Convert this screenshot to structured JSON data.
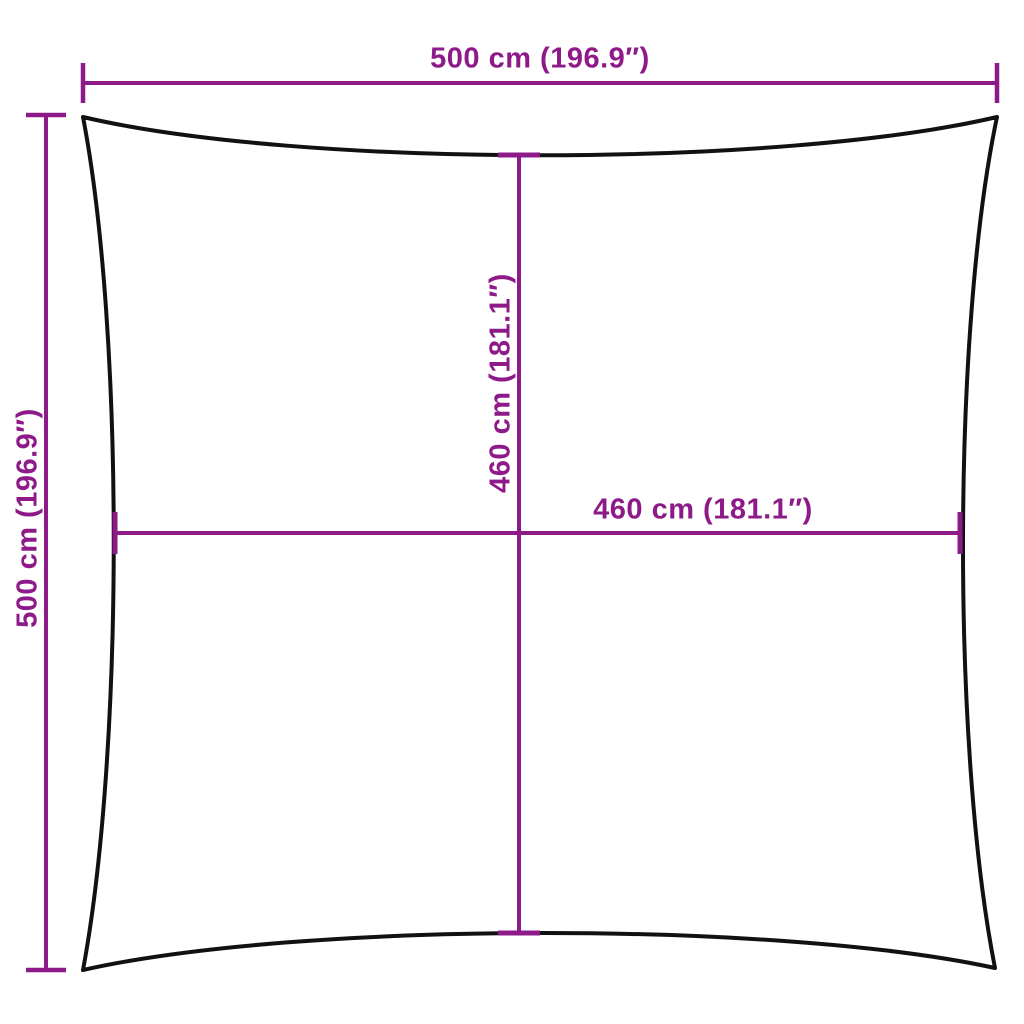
{
  "diagram": {
    "kind": "product-dimension-diagram",
    "product_shape": "square shade sail outline with concave edges",
    "colors": {
      "dimension_lines": "#8e1a89",
      "dimension_text": "#8e1a89",
      "product_outline": "#111111",
      "background": "#ffffff"
    },
    "dimensions": [
      {
        "id": "outer-width-top",
        "label": "500 cm (196.9″)",
        "cm": 500,
        "inches": 196.9,
        "orientation": "horizontal",
        "position": "top"
      },
      {
        "id": "outer-height-left",
        "label": "500 cm (196.9″)",
        "cm": 500,
        "inches": 196.9,
        "orientation": "vertical",
        "position": "left"
      },
      {
        "id": "inner-height-center",
        "label": "460 cm (181.1″)",
        "cm": 460,
        "inches": 181.1,
        "orientation": "vertical",
        "position": "center"
      },
      {
        "id": "inner-width-center",
        "label": "460 cm (181.1″)",
        "cm": 460,
        "inches": 181.1,
        "orientation": "horizontal",
        "position": "center"
      }
    ]
  }
}
